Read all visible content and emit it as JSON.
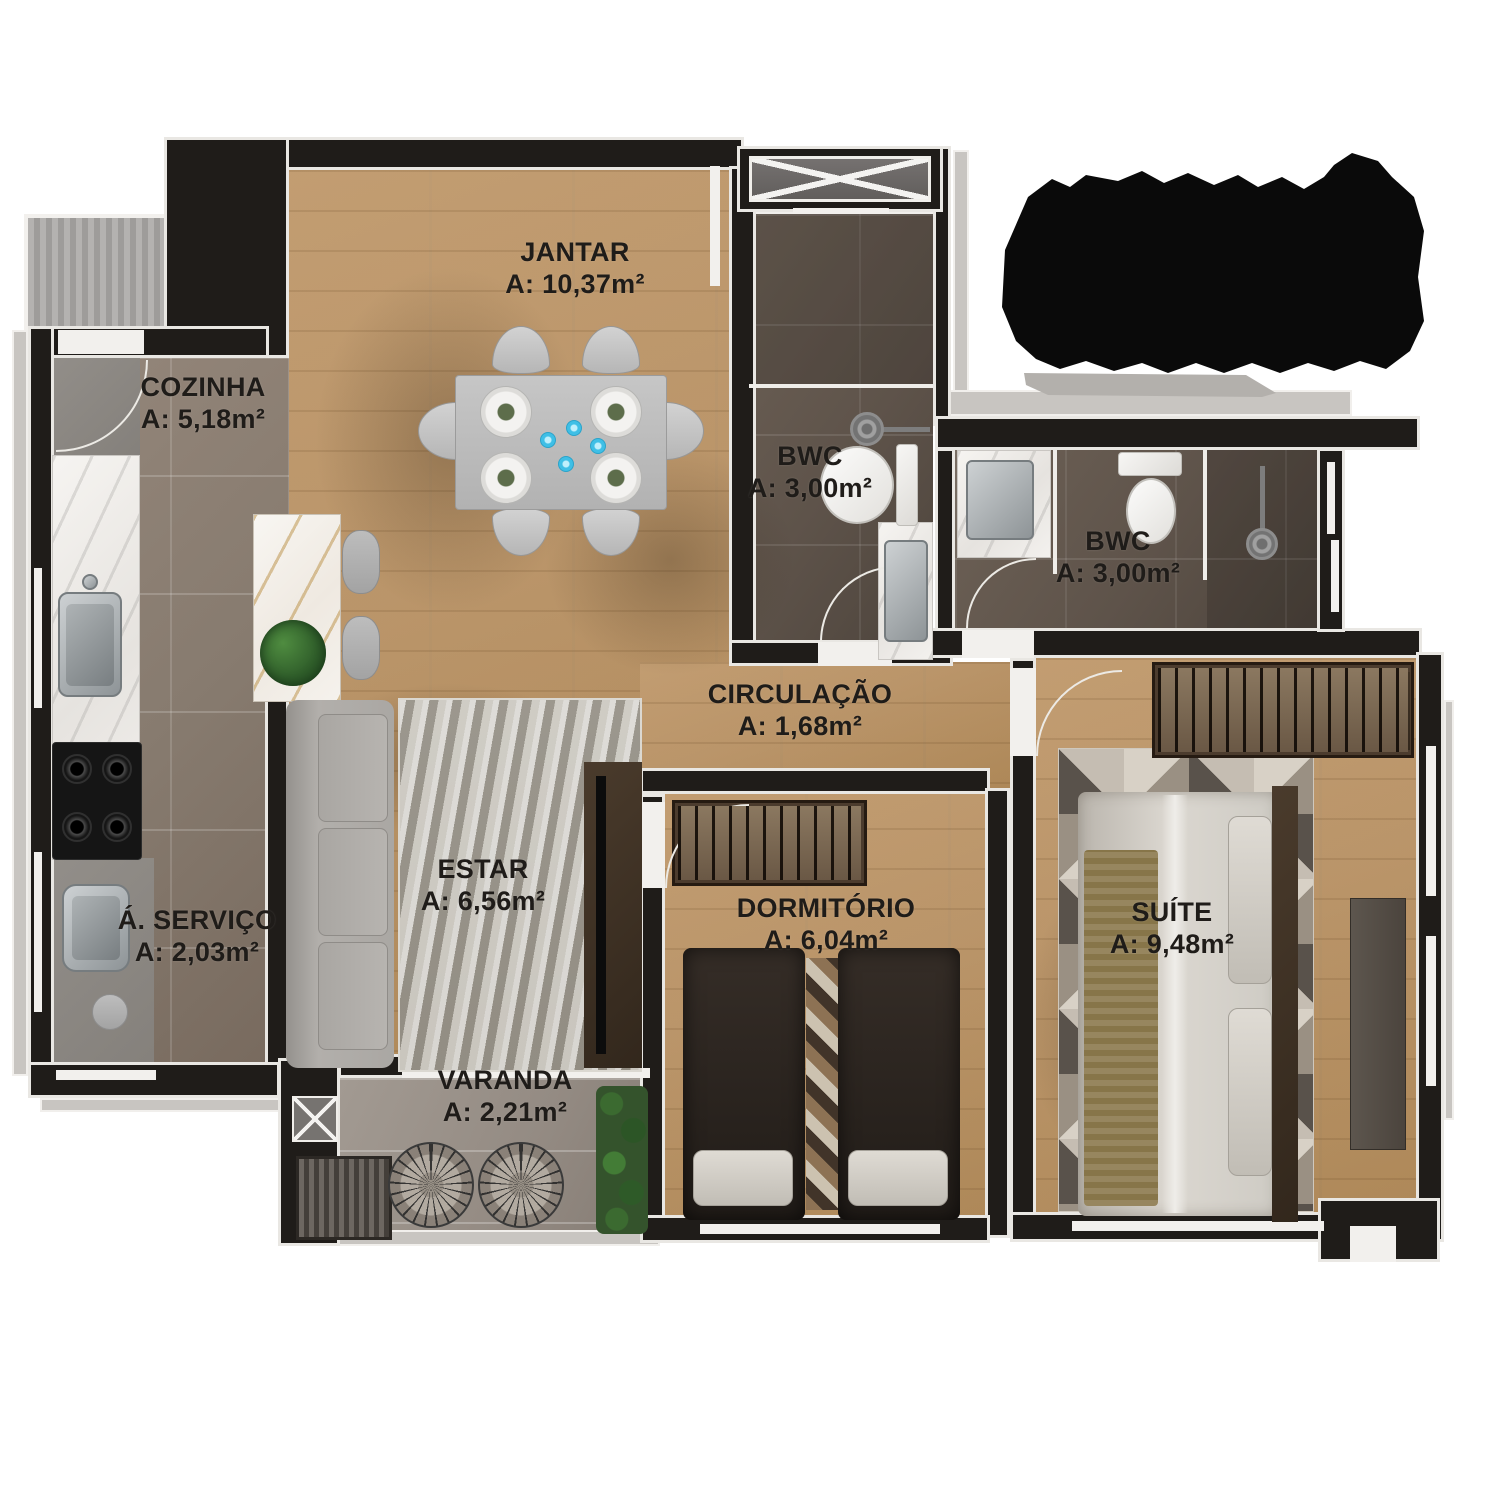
{
  "rooms": [
    {
      "id": "jantar",
      "name": "JANTAR",
      "area": "A: 10,37m²"
    },
    {
      "id": "cozinha",
      "name": "COZINHA",
      "area": "A: 5,18m²"
    },
    {
      "id": "bwc1",
      "name": "BWC",
      "area": "A: 3,00m²"
    },
    {
      "id": "bwc2",
      "name": "BWC",
      "area": "A: 3,00m²"
    },
    {
      "id": "circulacao",
      "name": "CIRCULAÇÃO",
      "area": "A: 1,68m²"
    },
    {
      "id": "estar",
      "name": "ESTAR",
      "area": "A: 6,56m²"
    },
    {
      "id": "servico",
      "name": "Á. SERVIÇO",
      "area": "A: 2,03m²"
    },
    {
      "id": "varanda",
      "name": "VARANDA",
      "area": "A: 2,21m²"
    },
    {
      "id": "dormitorio",
      "name": "DORMITÓRIO",
      "area": "A: 6,04m²"
    },
    {
      "id": "suite",
      "name": "SUÍTE",
      "area": "A: 9,48m²"
    }
  ],
  "title_block": {
    "legible": false,
    "note": "solid black obscured text block, top right"
  },
  "palette": {
    "wall": "#1f1c19",
    "trim": "#f1efec",
    "wood_floor": "#c6a073",
    "kitchen_tile": "#877b6f",
    "bath_tile": "#5e534a",
    "varanda_tile": "#948b83",
    "label_text": "#1f1c19",
    "cup_accent": "#3fbfe6"
  }
}
